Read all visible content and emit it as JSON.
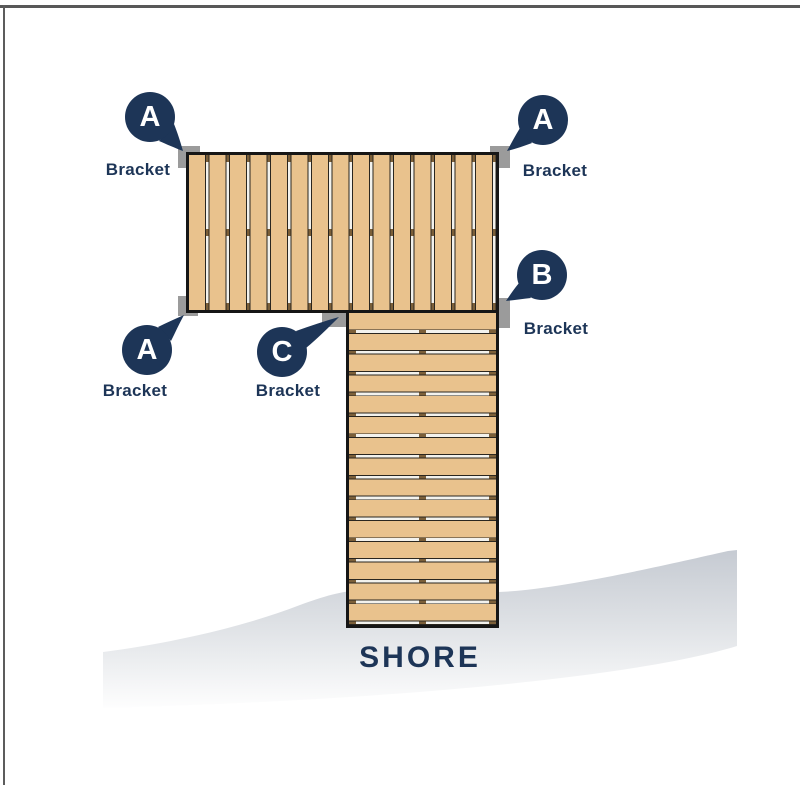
{
  "diagram": {
    "description": "Dock layout top view with bracket callouts",
    "shore_label": "SHORE",
    "badges": [
      {
        "id": "top-left",
        "letter": "A",
        "label": "Bracket"
      },
      {
        "id": "top-right",
        "letter": "A",
        "label": "Bracket"
      },
      {
        "id": "right",
        "letter": "B",
        "label": "Bracket"
      },
      {
        "id": "bottom-left",
        "letter": "A",
        "label": "Bracket"
      },
      {
        "id": "center",
        "letter": "C",
        "label": "Bracket"
      }
    ],
    "structure": {
      "deck": {
        "orientation": "vertical-planks",
        "plank_count": 15,
        "brackets": [
          "A",
          "A",
          "A"
        ]
      },
      "walkway": {
        "orientation": "horizontal-planks",
        "plank_count": 15,
        "brackets": [
          "B",
          "C"
        ]
      }
    },
    "colors": {
      "navy": "#1d3557",
      "plank_tan": "#e9c28d",
      "plank_gap": "#f3f2ed",
      "plank_line": "#2a261f",
      "deck_border": "#161616",
      "bracket_grey": "#9b9b9b",
      "shore_grey": "#c6cbd2",
      "background": "#ffffff"
    }
  }
}
